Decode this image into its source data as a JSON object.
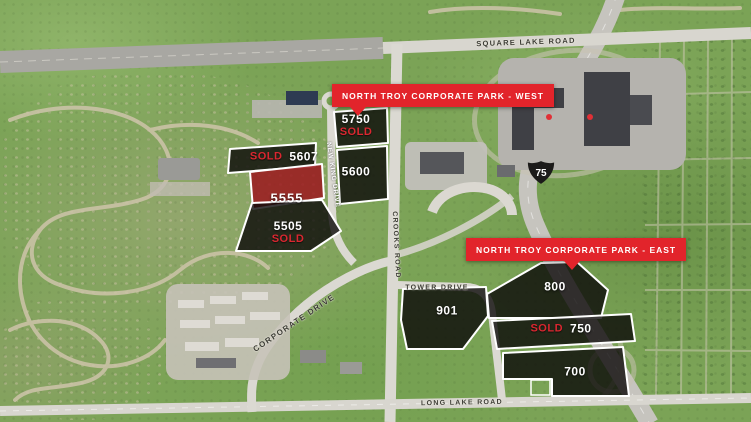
{
  "banners": {
    "west": "NORTH TROY CORPORATE PARK - WEST",
    "east": "NORTH TROY CORPORATE PARK - EAST"
  },
  "roads": {
    "square_lake": "SQUARE LAKE ROAD",
    "long_lake": "LONG LAKE ROAD",
    "crooks": "CROOKS ROAD",
    "tower": "TOWER DRIVE",
    "corporate": "CORPORATE DRIVE",
    "new_king": "NEW KING DRIVE"
  },
  "highway_shield": "75",
  "parcels": {
    "west": [
      {
        "number": "5750",
        "status": "SOLD"
      },
      {
        "number": "5607",
        "status": "SOLD"
      },
      {
        "number": "5555",
        "status": ""
      },
      {
        "number": "5600",
        "status": ""
      },
      {
        "number": "5505",
        "status": "SOLD"
      }
    ],
    "east": [
      {
        "number": "901",
        "status": ""
      },
      {
        "number": "800",
        "status": ""
      },
      {
        "number": "750",
        "status": "SOLD"
      },
      {
        "number": "700",
        "status": ""
      }
    ]
  },
  "colors": {
    "banner_red": "#e2242b",
    "sold_red": "#da2730",
    "available_parcel_red": "#9c171e",
    "parcel_overlay_black": "#0b0909",
    "parcel_outline_white": "#ffffff"
  }
}
